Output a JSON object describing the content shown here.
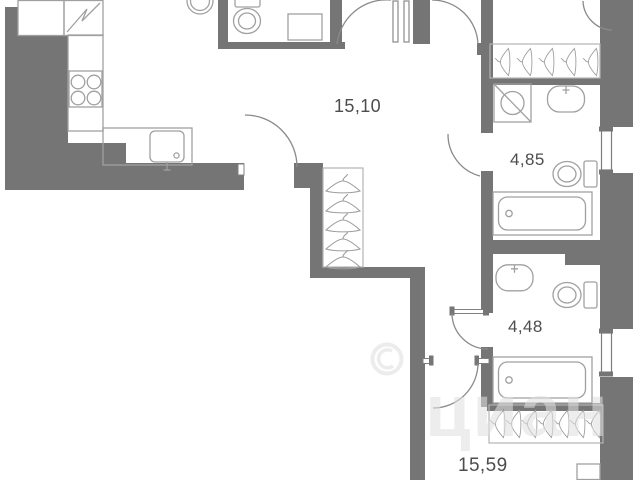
{
  "plan": {
    "type": "apartment-floor-plan",
    "rooms": [
      {
        "id": "kitchen-living",
        "area_label": "15,10"
      },
      {
        "id": "bathroom-upper",
        "area_label": "4,85"
      },
      {
        "id": "bathroom-lower",
        "area_label": "4,48"
      },
      {
        "id": "room-lower",
        "area_label": "15,59"
      }
    ],
    "watermark_text": "циан",
    "colors": {
      "wall": "#757575",
      "line": "#8a8a8a",
      "furniture": "#a0a0a0",
      "wardrobe": "#b3b3b3",
      "label": "#4d4d4d"
    }
  }
}
